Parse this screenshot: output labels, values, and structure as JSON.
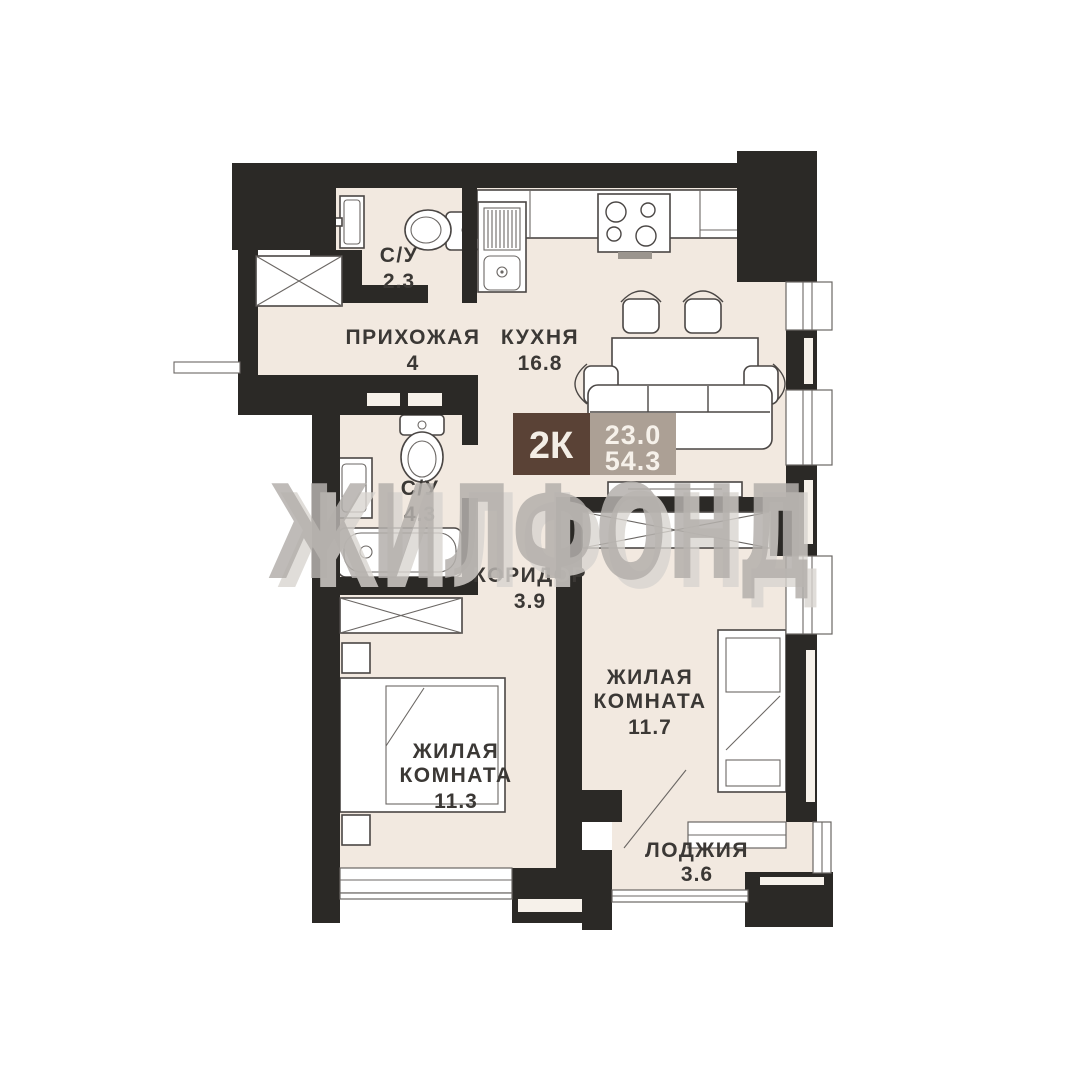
{
  "plan": {
    "watermark": "ЖИЛФОНД",
    "badge": {
      "rooms_label": "2К",
      "living_area": "23.0",
      "total_area": "54.3"
    },
    "rooms": {
      "bathroom_small": {
        "name": "С/У",
        "area": "2.3"
      },
      "hallway": {
        "name": "ПРИХОЖАЯ",
        "area": "4"
      },
      "kitchen": {
        "name": "КУХНЯ",
        "area": "16.8"
      },
      "bathroom_large": {
        "name": "С/У",
        "area": "4.3"
      },
      "corridor": {
        "name": "КОРИДОР",
        "area": "3.9"
      },
      "living_room_1": {
        "line1": "ЖИЛАЯ",
        "line2": "КОМНАТА",
        "area": "11.3"
      },
      "living_room_2": {
        "line1": "ЖИЛАЯ",
        "line2": "КОМНАТА",
        "area": "11.7"
      },
      "loggia": {
        "name": "ЛОДЖИЯ",
        "area": "3.6"
      }
    },
    "colors": {
      "wall": "#2b2926",
      "floor": "#f2e9e0",
      "badge_brown": "#5a4236",
      "badge_taupe": "#aca095",
      "label_text": "#3b3835",
      "watermark_gray": "#b4b0ac"
    }
  }
}
